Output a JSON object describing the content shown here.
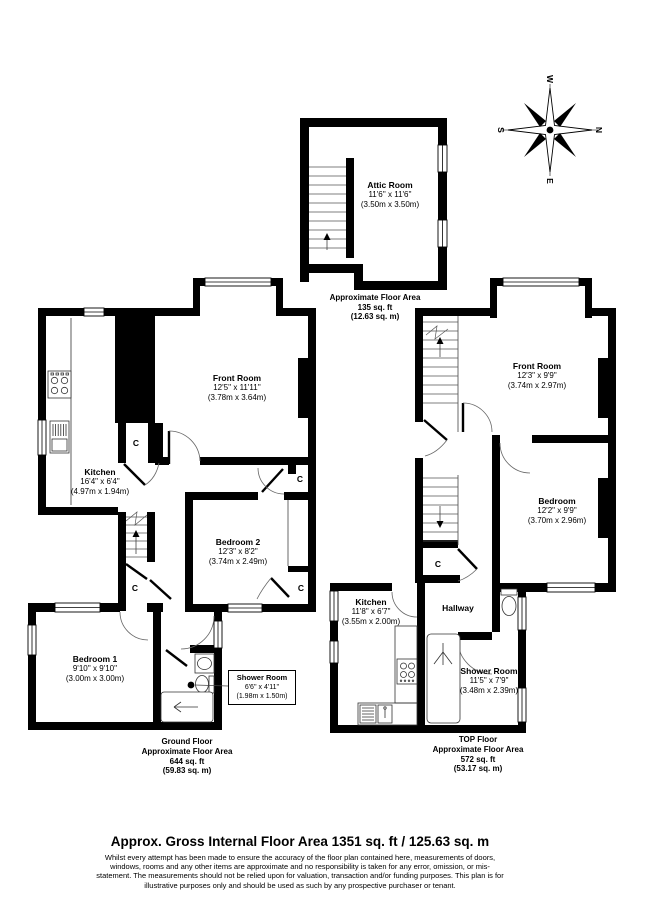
{
  "compass": {
    "n": "N",
    "e": "E",
    "s": "S",
    "w": "W"
  },
  "cupboard_label": "C",
  "attic": {
    "room": {
      "name": "Attic Room",
      "imperial": "11'6'' x 11'6''",
      "metric": "(3.50m x 3.50m)"
    },
    "area": {
      "floor": "Attic",
      "label": "Approximate Floor Area",
      "sqft": "135 sq. ft",
      "sqm": "(12.63 sq. m)"
    }
  },
  "ground": {
    "front_room": {
      "name": "Front Room",
      "imperial": "12'5'' x 11'11''",
      "metric": "(3.78m x 3.64m)"
    },
    "kitchen": {
      "name": "Kitchen",
      "imperial": "16'4\" x 6'4\"",
      "metric": "(4.97m x 1.94m)"
    },
    "bedroom2": {
      "name": "Bedroom 2",
      "imperial": "12'3\" x 8'2\"",
      "metric": "(3.74m x 2.49m)"
    },
    "bedroom1": {
      "name": "Bedroom 1",
      "imperial": "9'10'' x 9'10''",
      "metric": "(3.00m x 3.00m)"
    },
    "shower_room": {
      "name": "Shower Room",
      "imperial": "6'6'' x 4'11''",
      "metric": "(1.98m x 1.50m)"
    },
    "area": {
      "floor": "Ground Floor",
      "label": "Approximate Floor Area",
      "sqft": "644 sq. ft",
      "sqm": "(59.83 sq. m)"
    }
  },
  "top": {
    "front_room": {
      "name": "Front Room",
      "imperial": "12'3\" x 9'9\"",
      "metric": "(3.74m x 2.97m)"
    },
    "bedroom": {
      "name": "Bedroom",
      "imperial": "12'2\" x 9'9\"",
      "metric": "(3.70m x 2.96m)"
    },
    "kitchen": {
      "name": "Kitchen",
      "imperial": "11'8\" x 6'7\"",
      "metric": "(3.55m x 2.00m)"
    },
    "hallway": {
      "name": "Hallway"
    },
    "shower_room": {
      "name": "Shower Room",
      "imperial": "11'5\" x 7'9\"",
      "metric": "(3.48m x 2.39m)"
    },
    "area": {
      "floor": "TOP Floor",
      "label": "Approximate Floor Area",
      "sqft": "572 sq. ft",
      "sqm": "(53.17 sq. m)"
    }
  },
  "footer": {
    "title": "Approx. Gross Internal Floor Area 1351 sq. ft / 125.63 sq. m",
    "disclaimer": "Whilst every attempt has been made to ensure the accuracy of the floor plan contained here, measurements of doors, windows, rooms and any other items are approximate and no responsibility is taken for any error, omission, or mis-statement. The measurements should not be relied upon for valuation, transaction and/or funding purposes. This plan is for illustrative purposes only and should be used as such by any prospective purchaser or tenant."
  }
}
